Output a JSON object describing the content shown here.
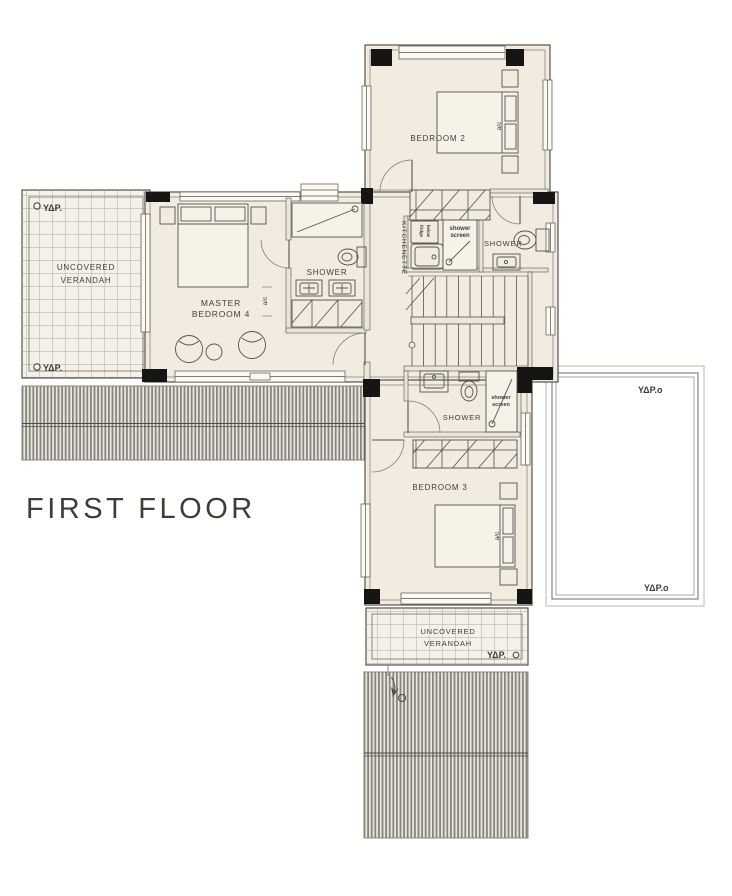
{
  "title": "FIRST FLOOR",
  "colors": {
    "background": "#ffffff",
    "floor_fill": "#f1ecdf",
    "wall_line": "#55534c",
    "column_fill": "#151513",
    "deck_stripe": "#87857d",
    "tile_line": "#93908a",
    "text": "#3f3d38"
  },
  "rooms": {
    "bedroom2": "BEDROOM 2",
    "master_bedroom_line1": "MASTER",
    "master_bedroom_line2": "BEDROOM 4",
    "bedroom3": "BEDROOM 3",
    "kitchenette": "KITCHENETTE",
    "shower_bed2": "SHOWER",
    "shower_master": "SHOWER",
    "shower_bed3": "SHOWER",
    "verandah_left_line1": "UNCOVERED",
    "verandah_left_line2": "VERANDAH",
    "verandah_bottom_line1": "UNCOVERED",
    "verandah_bottom_line2": "VERANDAH"
  },
  "annotations": {
    "shower_screen_line1": "shower",
    "shower_screen_line2": "screen",
    "ac": "a/c",
    "appliance_line1": "fridge",
    "appliance_line2": "below",
    "hydro": "ΥΔΡ.",
    "hydro_o": "ΥΔΡ.ο"
  }
}
